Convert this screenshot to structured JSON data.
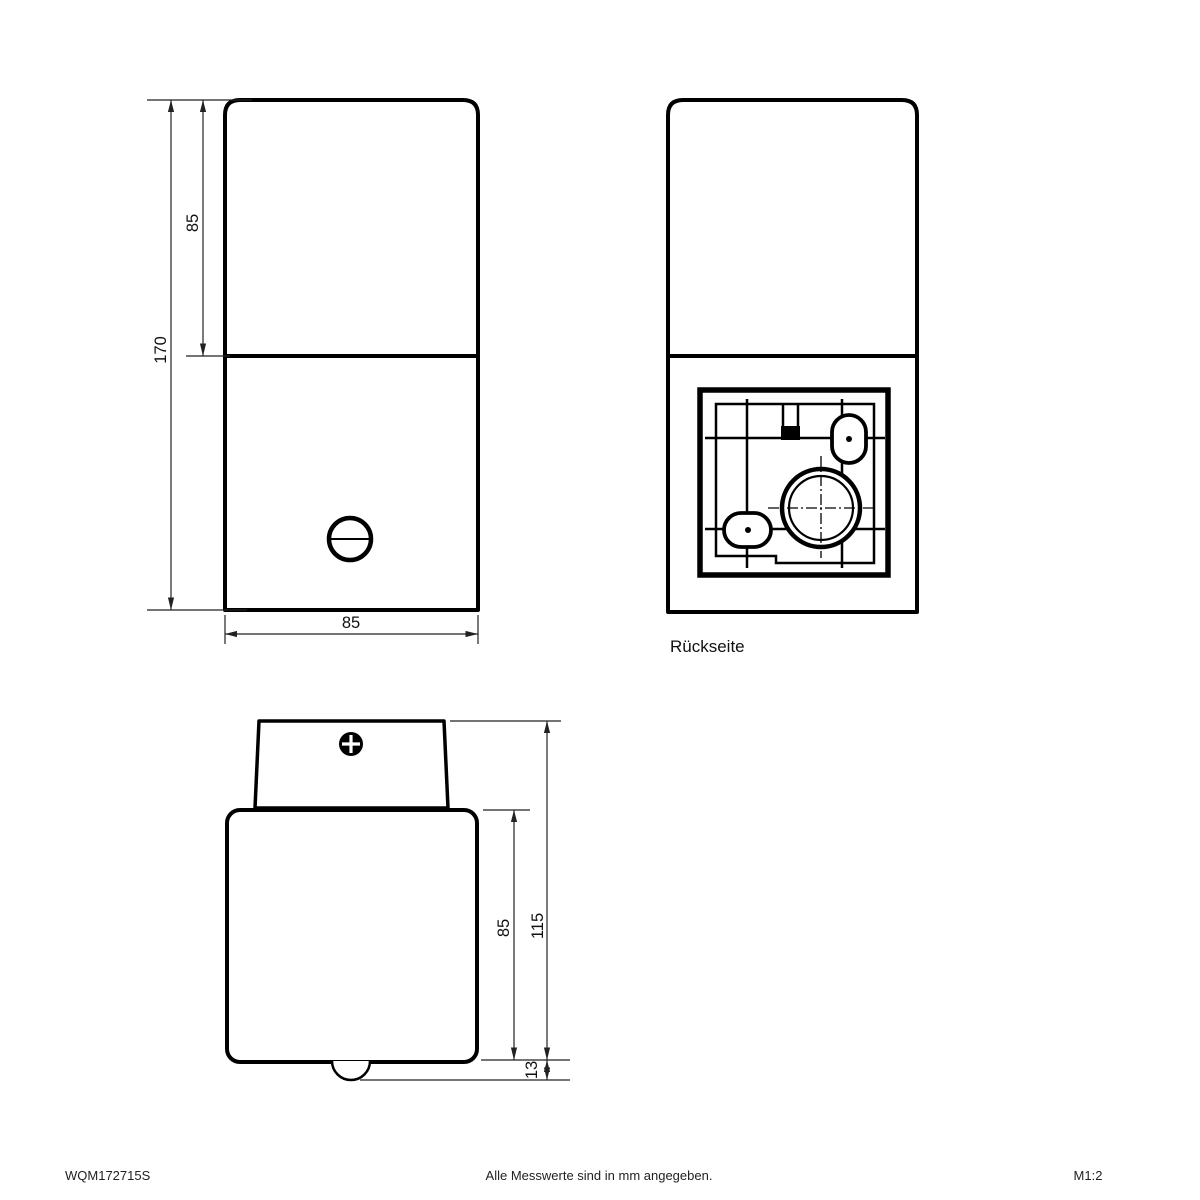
{
  "colors": {
    "line": "#000000",
    "dimension_line": "#222222",
    "background": "#ffffff"
  },
  "views": {
    "front": {
      "dim_total_height": "170",
      "dim_upper_section_height": "85",
      "dim_width": "85"
    },
    "back": {
      "caption": "Rückseite"
    },
    "top": {
      "dim_body_depth": "85",
      "dim_total_depth": "115",
      "dim_sensor_protrusion": "13"
    }
  },
  "footer": {
    "article_number": "WQM172715S",
    "note": "Alle Messwerte sind in mm angegeben.",
    "scale": "M1:2"
  }
}
